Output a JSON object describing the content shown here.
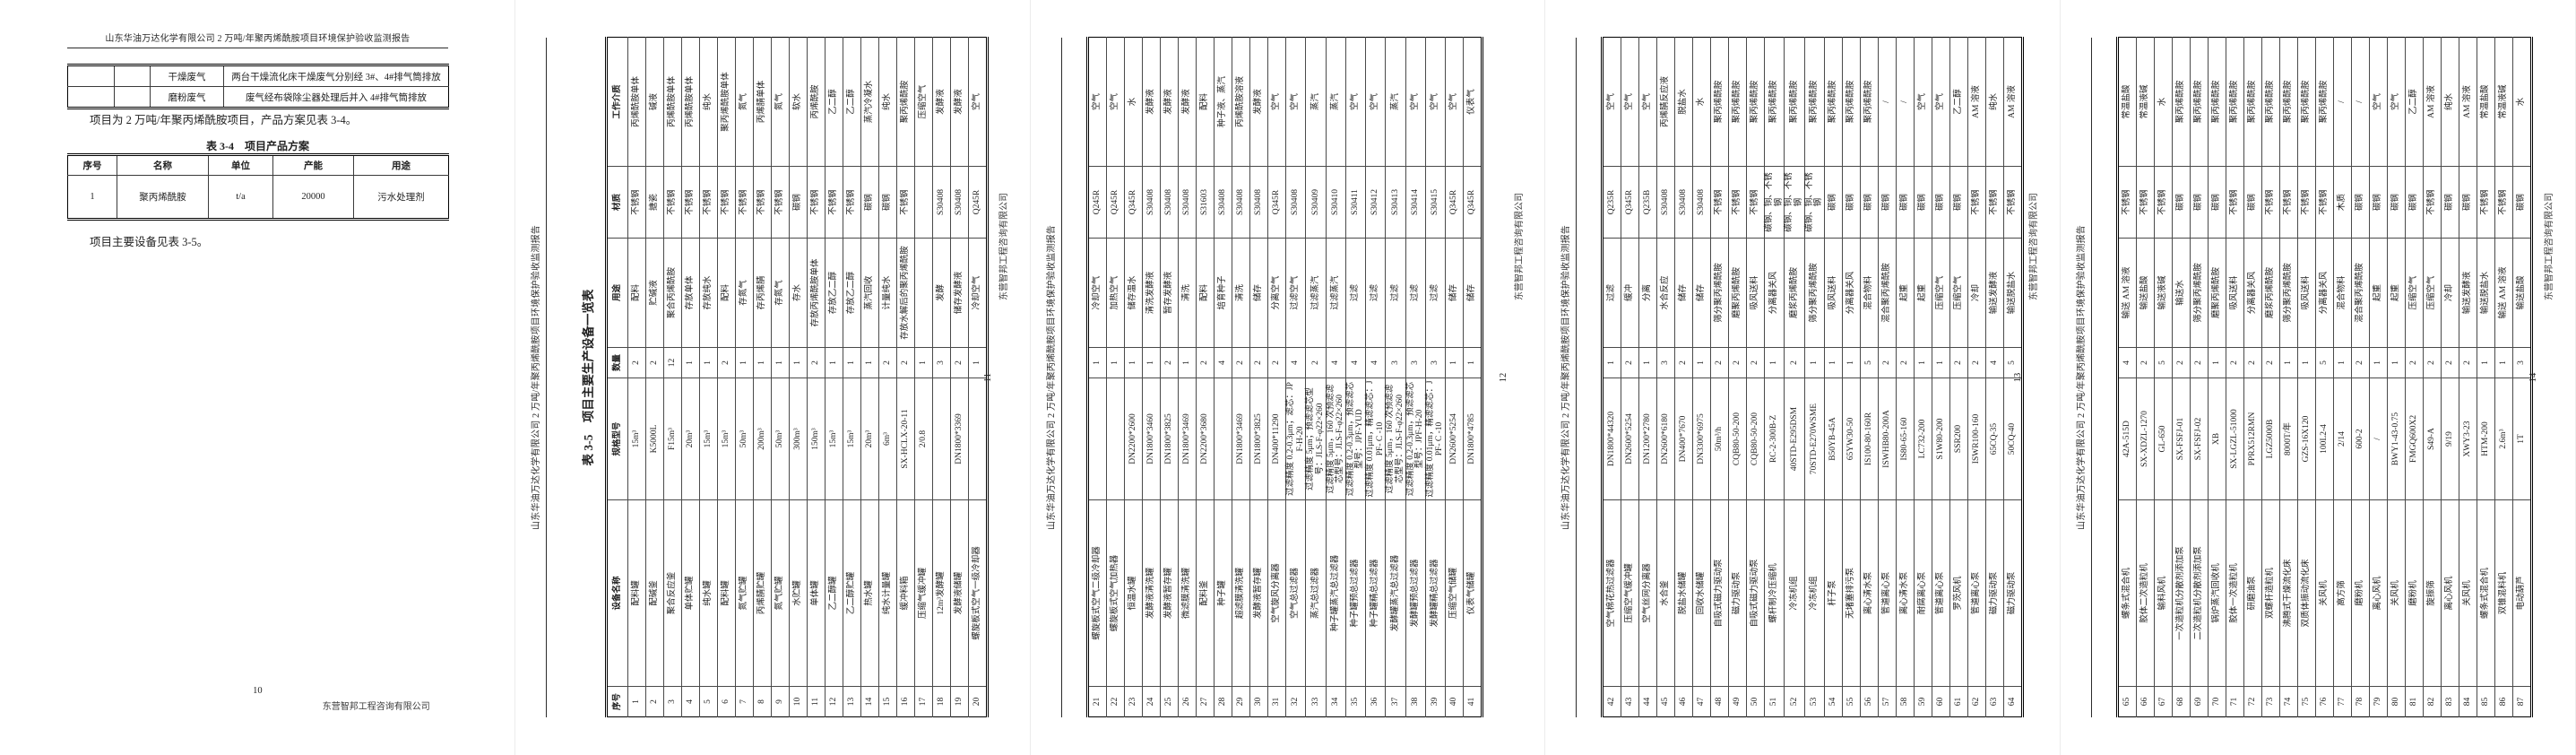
{
  "report_header": "山东华油万达化学有限公司 2 万吨/年聚丙烯酰胺项目环境保护验收监测报告",
  "company_name": "东营智邦工程咨询有限公司",
  "page1": {
    "page_number": "10",
    "carryover_table": {
      "rows": [
        [
          "",
          "",
          "干燥废气",
          "两台干燥流化床干燥废气分别经 3#、4#排气筒排放"
        ],
        [
          "",
          "",
          "磨粉废气",
          "废气经布袋除尘器处理后并入 4#排气筒排放"
        ]
      ]
    },
    "paragraph_product": "项目为 2 万吨/年聚丙烯酰胺项目，产品方案见表 3-4。",
    "table_3_4": {
      "title": "表 3-4　项目产品方案",
      "headers": [
        "序号",
        "名称",
        "单位",
        "产能",
        "用途"
      ],
      "rows": [
        [
          "1",
          "聚丙烯酰胺",
          "t/a",
          "20000",
          "污水处理剂"
        ]
      ]
    },
    "paragraph_equipment": "项目主要设备见表 3-5。"
  },
  "table_3_5": {
    "title": "表 3-5　项目主要生产设备一览表",
    "headers": [
      "序号",
      "设备名称",
      "规格型号",
      "数量",
      "用途",
      "材质",
      "工作介质"
    ],
    "pages": [
      {
        "page_number": "11",
        "rows": [
          [
            "1",
            "配料罐",
            "15m³",
            "2",
            "配料",
            "不锈钢",
            "丙烯酰胺单体"
          ],
          [
            "2",
            "配碱釜",
            "K5000L",
            "2",
            "贮碱液",
            "搪瓷",
            "碱液"
          ],
          [
            "3",
            "聚合反应釜",
            "F15m³",
            "12",
            "聚合丙烯酰胺",
            "不锈钢",
            "丙烯酰胺单体"
          ],
          [
            "4",
            "单体贮罐",
            "20m³",
            "1",
            "存放单体",
            "不锈钢",
            "丙烯酰胺单体"
          ],
          [
            "5",
            "纯水罐",
            "15m³",
            "1",
            "存放纯水",
            "不锈钢",
            "纯水"
          ],
          [
            "6",
            "配料罐",
            "15m³",
            "2",
            "配料",
            "不锈钢",
            "聚丙烯酰胺单体"
          ],
          [
            "7",
            "氮气贮罐",
            "50m³",
            "1",
            "存氮气",
            "不锈钢",
            "氮气"
          ],
          [
            "8",
            "丙烯腈贮罐",
            "200m³",
            "1",
            "存丙烯腈",
            "不锈钢",
            "丙烯腈单体"
          ],
          [
            "9",
            "氮气贮罐",
            "50m³",
            "1",
            "存氮气",
            "不锈钢",
            "氮气"
          ],
          [
            "10",
            "水贮罐",
            "300m³",
            "1",
            "存水",
            "碳钢",
            "软水"
          ],
          [
            "11",
            "单体罐",
            "150m³",
            "2",
            "存放丙烯酰胺单体",
            "不锈钢",
            "丙烯酰胺"
          ],
          [
            "12",
            "乙二醇罐",
            "15m³",
            "1",
            "存放乙二醇",
            "不锈钢",
            "乙二醇"
          ],
          [
            "13",
            "乙二醇贮罐",
            "15m³",
            "1",
            "存放乙二醇",
            "不锈钢",
            "乙二醇"
          ],
          [
            "14",
            "热水罐",
            "20m³",
            "1",
            "蒸汽回收",
            "碳钢",
            "蒸汽冷凝水"
          ],
          [
            "15",
            "纯水计量罐",
            "6m³",
            "2",
            "计量纯水",
            "碳钢",
            "纯水"
          ],
          [
            "16",
            "缓冲料箱",
            "SX-HCLX-20-11",
            "2",
            "存放水解后的聚丙烯酰胺",
            "不锈钢",
            "聚丙烯酰胺"
          ],
          [
            "17",
            "压缩气缓冲罐",
            "2/0.8",
            "1",
            "",
            "",
            "压缩空气"
          ],
          [
            "18",
            "12m³发酵罐",
            "",
            "3",
            "发酵",
            "S30408",
            "发酵液"
          ],
          [
            "19",
            "发酵液储罐",
            "DN1800*3369",
            "2",
            "储存发酵液",
            "S30408",
            "发酵液"
          ],
          [
            "20",
            "螺旋板式空气一级冷却器",
            "",
            "1",
            "冷却空气",
            "Q245R",
            "空气"
          ]
        ]
      },
      {
        "page_number": "12",
        "rows": [
          [
            "21",
            "螺旋板式空气二级冷却器",
            "",
            "1",
            "冷却空气",
            "Q245R",
            "空气"
          ],
          [
            "22",
            "螺旋板式空气加热器",
            "",
            "1",
            "加热空气",
            "Q245R",
            "空气"
          ],
          [
            "23",
            "恒温水罐",
            "DN2200*2600",
            "1",
            "储存温水",
            "Q345R",
            "水"
          ],
          [
            "24",
            "发酵液清洗罐",
            "DN1800*3460",
            "1",
            "清洗发酵液",
            "S30408",
            "发酵液"
          ],
          [
            "25",
            "发酵液暂存罐",
            "DN1800*3825",
            "2",
            "暂存发酵液",
            "S30408",
            "发酵液"
          ],
          [
            "26",
            "微滤膜清洗罐",
            "DN1800*3469",
            "1",
            "清洗",
            "S30408",
            "发酵液"
          ],
          [
            "27",
            "配料釜",
            "DN2200*3680",
            "2",
            "配料",
            "S31603",
            "配料"
          ],
          [
            "28",
            "种子罐",
            "",
            "4",
            "培育种子",
            "S30408",
            "种子液、蒸汽"
          ],
          [
            "29",
            "超滤膜清洗罐",
            "DN1800*3469",
            "2",
            "清洗",
            "S30408",
            "丙烯酰胺溶液"
          ],
          [
            "30",
            "发酵液暂存罐",
            "DN1800*3825",
            "2",
            "储存",
            "S30408",
            "发酵液"
          ],
          [
            "31",
            "空气旋风分离器",
            "DN400*11290",
            "2",
            "分离空气",
            "Q345R",
            "空气"
          ],
          [
            "32",
            "空气总过滤器",
            "过滤精度 0.2-0.3μm；滤芯：JPF-H-20",
            "4",
            "过滤空气",
            "S30408",
            "空气"
          ],
          [
            "33",
            "蒸汽总过滤器",
            "过滤精度 5μm；预滤滤芯型号：JLS-F-φ22×260",
            "2",
            "过滤蒸汽",
            "S30409",
            "蒸汽"
          ],
          [
            "34",
            "种子罐蒸汽总过滤器",
            "过滤精度 5μm，160 次预滤滤芯型号：JLS-F-φ22×260",
            "4",
            "过滤蒸汽",
            "S30410",
            "蒸汽"
          ],
          [
            "35",
            "种子罐预总过滤器",
            "过滤精度 0.2-0.3μm，预滤滤芯型号：JPF-YUD",
            "4",
            "过滤",
            "S30411",
            "空气"
          ],
          [
            "36",
            "种子罐精总过滤器",
            "过滤精度 0.01μm，精滤滤芯：JPF- C -10",
            "4",
            "过滤",
            "S30412",
            "空气"
          ],
          [
            "37",
            "发酵罐蒸汽总过滤器",
            "过滤精度 5μm，160 次预滤滤芯型号：JLS-F-φ22×260",
            "3",
            "过滤",
            "S30413",
            "蒸汽"
          ],
          [
            "38",
            "发酵罐预总过滤器",
            "过滤精度 0.2-0.3μm，预滤滤芯型号：JPF-H-20",
            "3",
            "过滤",
            "S30414",
            "空气"
          ],
          [
            "39",
            "发酵罐精总过滤器",
            "过滤精度 0.01μm，精滤滤芯：JPF- C -10",
            "3",
            "过滤",
            "S30415",
            "空气"
          ],
          [
            "40",
            "压缩空气储罐",
            "DN2600*5254",
            "1",
            "储存",
            "Q345R",
            "空气"
          ],
          [
            "41",
            "仪表气储罐",
            "DN1800*4785",
            "1",
            "储存",
            "Q345R",
            "仪表气"
          ]
        ]
      },
      {
        "page_number": "13",
        "rows": [
          [
            "42",
            "空气棉花热过滤器",
            "DN1800*44320",
            "1",
            "过滤",
            "Q235R",
            "空气"
          ],
          [
            "43",
            "压缩空气缓冲罐",
            "DN2600*5254",
            "2",
            "缓冲",
            "Q345R",
            "空气"
          ],
          [
            "44",
            "空气丝网分离器",
            "DN1200*2780",
            "1",
            "分离",
            "Q235B",
            "空气"
          ],
          [
            "45",
            "水合釜",
            "DN2600*6180",
            "3",
            "水合反应",
            "S30408",
            "丙烯腈反应液"
          ],
          [
            "46",
            "脱盐水储罐",
            "DN400*7670",
            "2",
            "储存",
            "S30408",
            "脱盐水"
          ],
          [
            "47",
            "回收水储罐",
            "DN3300*6975",
            "1",
            "储存",
            "S30408",
            "水"
          ],
          [
            "48",
            "自吸式磁力驱动泵",
            "50m³/h",
            "2",
            "筛分聚丙烯酰胺",
            "不锈钢",
            "聚丙烯酰胺"
          ],
          [
            "49",
            "磁力驱动泵",
            "CQB80-50-200",
            "2",
            "磨聚丙烯酰胺",
            "不锈钢",
            "聚丙烯酰胺"
          ],
          [
            "50",
            "自吸式磁力驱动泵",
            "CQB80-50-200",
            "2",
            "吸风送料",
            "不锈钢",
            "聚丙烯酰胺"
          ],
          [
            "51",
            "螺杆制冷压缩机",
            "RC-2-300B-Z",
            "1",
            "分离器关风",
            "碳钢、铜、不锈钢",
            "聚丙烯酰胺"
          ],
          [
            "52",
            "冷冻机组",
            "40STD-E295DSM",
            "2",
            "磨浆丙烯酰胺",
            "碳钢、铜、不锈钢",
            "聚丙烯酰胺"
          ],
          [
            "53",
            "冷冻机组",
            "70STD-E270WSME",
            "1",
            "筛分聚丙烯酰胺",
            "碳钢、铜、不锈钢",
            "聚丙烯酰胺"
          ],
          [
            "54",
            "杆子泵",
            "B50YB-45A",
            "1",
            "吸风送料",
            "碳钢",
            "聚丙烯酰胺"
          ],
          [
            "55",
            "无堵塞排污泵",
            "65YW30-50",
            "1",
            "分离器关风",
            "碳钢",
            "聚丙烯酰胺"
          ],
          [
            "56",
            "离心清水泵",
            "IS100-80-160R",
            "5",
            "混合物料",
            "碳钢",
            "聚丙烯酰胺"
          ],
          [
            "57",
            "管道离心泵",
            "ISWHB80-200A",
            "2",
            "混合聚丙烯酰胺",
            "碳钢",
            "/"
          ],
          [
            "58",
            "离心清水泵",
            "IS80-65-160",
            "2",
            "起重",
            "碳钢",
            "/"
          ],
          [
            "59",
            "耐腐离心泵",
            "LC732-200",
            "1",
            "起重",
            "碳钢",
            "空气"
          ],
          [
            "60",
            "管道离心泵",
            "S1W80-200",
            "1",
            "压缩空气",
            "碳钢",
            "空气"
          ],
          [
            "61",
            "罗茨风机",
            "SSR200",
            "2",
            "压缩空气",
            "碳钢",
            "乙二醇"
          ],
          [
            "62",
            "管道离心泵",
            "ISWR100-160",
            "2",
            "冷却",
            "不锈钢",
            "AM 溶液"
          ],
          [
            "63",
            "磁力驱动泵",
            "65CQ-35",
            "4",
            "输送发酵液",
            "不锈钢",
            "纯水"
          ],
          [
            "64",
            "磁力驱动泵",
            "50CQ-40",
            "5",
            "输送脱盐水",
            "不锈钢",
            "AM 溶液"
          ]
        ]
      },
      {
        "page_number": "14",
        "rows": [
          [
            "65",
            "螺条式混合机",
            "42A-515D",
            "4",
            "输送 AM 溶液",
            "不锈钢",
            "常温盐酸"
          ],
          [
            "66",
            "胶体二次造粒机",
            "SX-XDZL-1270",
            "2",
            "输送盐酸",
            "不锈钢",
            "常温液碱"
          ],
          [
            "67",
            "输料风机",
            "GL-650",
            "5",
            "输送液碱",
            "不锈钢",
            "水"
          ],
          [
            "68",
            "一次造粒机分散剂添加泵",
            "SX-FSFJ-01",
            "2",
            "输送水",
            "碳钢",
            "聚丙烯酰胺"
          ],
          [
            "69",
            "二次造粒机分散剂添加泵",
            "SX-FSFJ-02",
            "2",
            "筛分聚丙烯酰胺",
            "碳钢",
            "聚丙烯酰胺"
          ],
          [
            "70",
            "锅炉蒸汽回收机",
            "XB",
            "1",
            "磨聚丙烯酰胺",
            "碳钢",
            "聚丙烯酰胺"
          ],
          [
            "71",
            "胶体一次造粒机",
            "SX-LGZL-51000",
            "2",
            "吸风送料",
            "不锈钢",
            "聚丙烯酰胺"
          ],
          [
            "72",
            "研磨油泵",
            "PPRX512RMN",
            "2",
            "分离器关风",
            "碳钢",
            "聚丙烯酰胺"
          ],
          [
            "73",
            "双螺杆造粒机",
            "LGZ5000B",
            "2",
            "磨浆丙烯酰胺",
            "不锈钢",
            "聚丙烯酰胺"
          ],
          [
            "74",
            "沸腾式干燥流化床",
            "8000T/年",
            "1",
            "筛分聚丙烯酰胺",
            "不锈钢",
            "聚丙烯酰胺"
          ],
          [
            "75",
            "双质体振动流化床",
            "GZS-16X120",
            "1",
            "吸风送料",
            "不锈钢",
            "聚丙烯酰胺"
          ],
          [
            "76",
            "关风机",
            "100L2-4",
            "5",
            "分离器关风",
            "不锈钢",
            "聚丙烯酰胺"
          ],
          [
            "77",
            "高方筛",
            "2/14",
            "1",
            "混合物料",
            "木质",
            "/"
          ],
          [
            "78",
            "磨粉机",
            "600-2",
            "2",
            "混合聚丙烯酰胺",
            "碳钢",
            "/"
          ],
          [
            "79",
            "离心风机",
            "/",
            "1",
            "起重",
            "碳钢",
            "空气"
          ],
          [
            "80",
            "关风机",
            "BWY1-43-0.75",
            "1",
            "起重",
            "碳钢",
            "空气"
          ],
          [
            "81",
            "磨粉机",
            "FMGQ600X2",
            "2",
            "压缩空气",
            "碳钢",
            "乙二醇"
          ],
          [
            "82",
            "旋振筛",
            "S49-A",
            "2",
            "压缩空气",
            "不锈钢",
            "AM 溶液"
          ],
          [
            "83",
            "离心风机",
            "9/19",
            "2",
            "冷却",
            "碳钢",
            "纯水"
          ],
          [
            "84",
            "关风机",
            "XWY3-23",
            "2",
            "输送发酵液",
            "碳钢",
            "AM 溶液"
          ],
          [
            "85",
            "螺条式混合机",
            "HTM-200",
            "1",
            "输送脱盐水",
            "不锈钢",
            "常温盐酸"
          ],
          [
            "86",
            "双锥混料机",
            "2.6m³",
            "1",
            "输送 AM 溶液",
            "不锈钢",
            "常温液碱"
          ],
          [
            "87",
            "电动葫芦",
            "1T",
            "3",
            "输送盐酸",
            "碳钢",
            "水"
          ]
        ]
      }
    ]
  }
}
